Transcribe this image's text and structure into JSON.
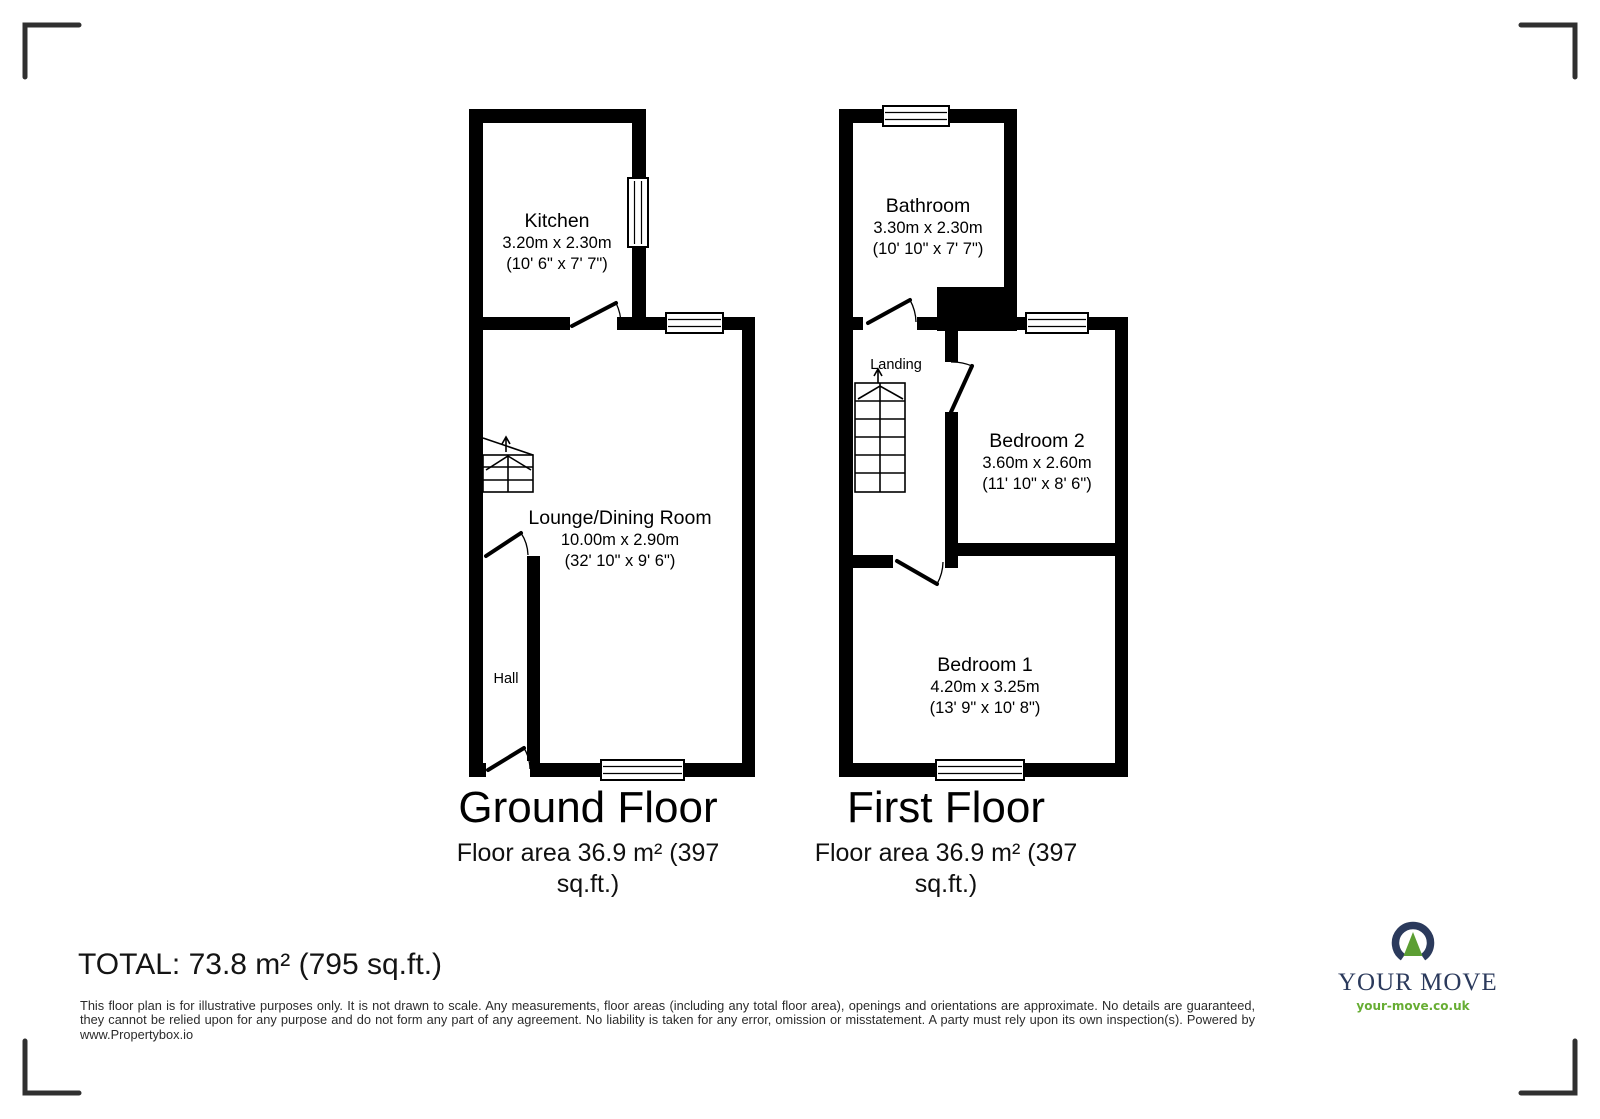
{
  "ground_floor": {
    "title": "Ground Floor",
    "area_line1": "Floor area 36.9 m² (397",
    "area_line2": "sq.ft.)",
    "kitchen": {
      "name": "Kitchen",
      "dims_metric": "3.20m x 2.30m",
      "dims_imperial": "(10' 6\" x 7' 7\")"
    },
    "lounge": {
      "name": "Lounge/Dining Room",
      "dims_metric": "10.00m x 2.90m",
      "dims_imperial": "(32' 10\" x 9' 6\")"
    },
    "hall": {
      "name": "Hall"
    }
  },
  "first_floor": {
    "title": "First Floor",
    "area_line1": "Floor area 36.9 m² (397",
    "area_line2": "sq.ft.)",
    "bathroom": {
      "name": "Bathroom",
      "dims_metric": "3.30m x 2.30m",
      "dims_imperial": "(10' 10\" x 7' 7\")"
    },
    "landing": {
      "name": "Landing"
    },
    "bedroom2": {
      "name": "Bedroom 2",
      "dims_metric": "3.60m x 2.60m",
      "dims_imperial": "(11' 10\" x 8' 6\")"
    },
    "bedroom1": {
      "name": "Bedroom 1",
      "dims_metric": "4.20m x 3.25m",
      "dims_imperial": "(13' 9\" x 10' 8\")"
    }
  },
  "summary": {
    "total": "TOTAL: 73.8 m² (795 sq.ft.)"
  },
  "disclaimer": {
    "text": "This floor plan is for illustrative purposes only. It is not drawn to scale. Any measurements, floor areas (including any total floor area), openings and orientations are approximate. No details are guaranteed, they cannot be relied upon for any purpose and do not form any part of any agreement. No liability is taken for any error, omission or misstatement. A party must rely upon its own inspection(s). Powered by www.Propertybox.io"
  },
  "logo": {
    "name": "YOUR MOVE",
    "website": "your-move.co.uk",
    "colors": {
      "navy": "#2b3a5c",
      "green": "#5c9e33",
      "link_green": "#67ad33"
    }
  },
  "plan_colors": {
    "wall": "#000000",
    "background": "#ffffff"
  }
}
